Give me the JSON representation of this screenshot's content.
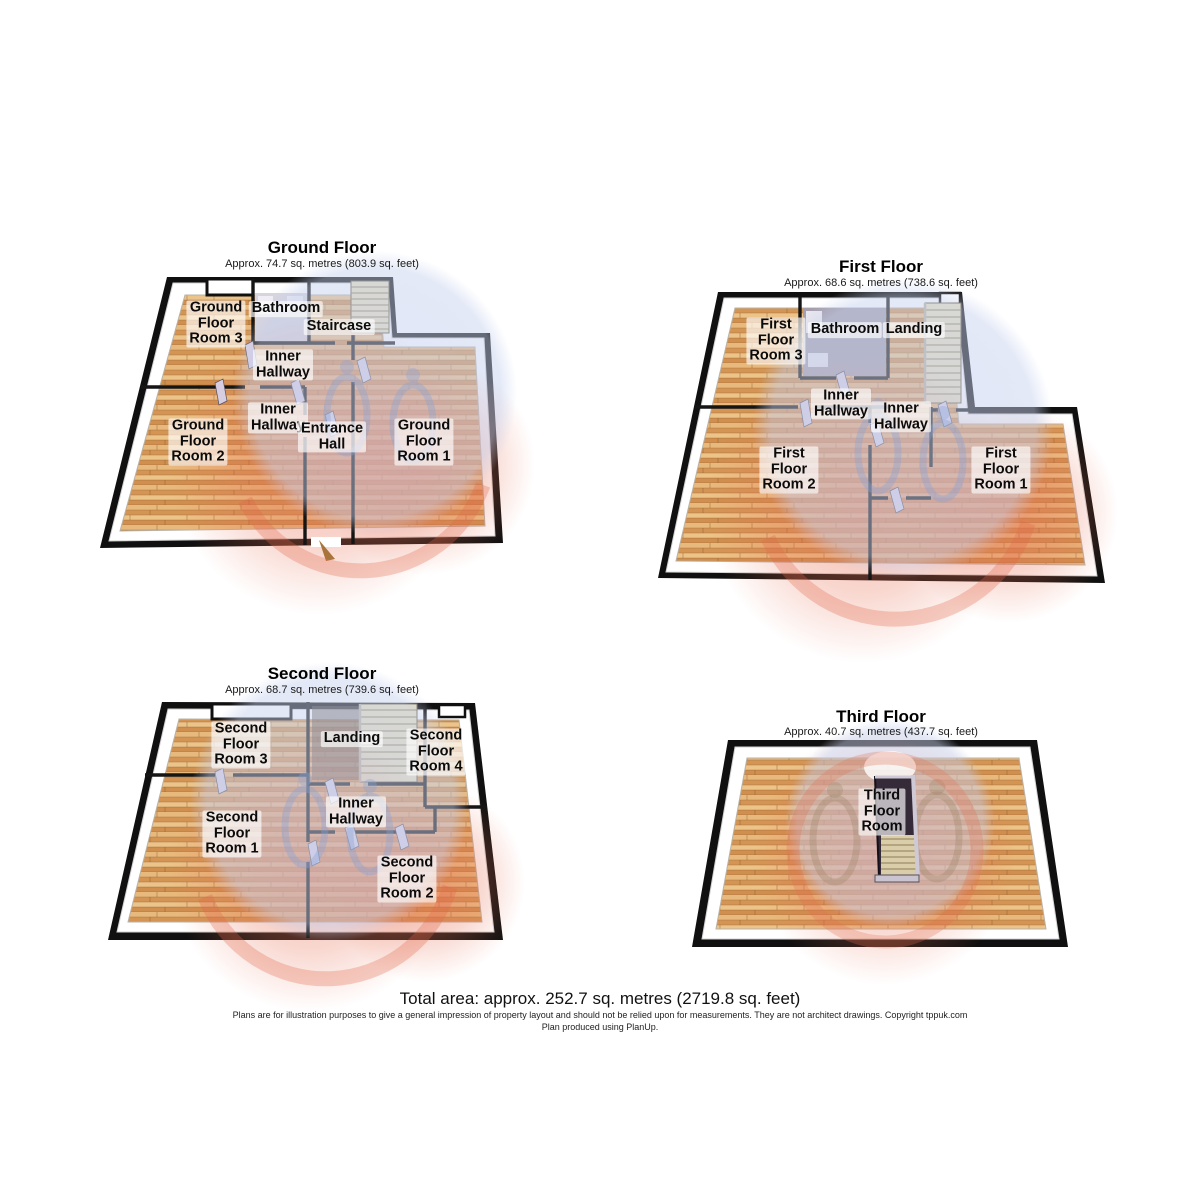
{
  "floors": [
    {
      "title": "Ground Floor",
      "area": "Approx. 74.7 sq. metres (803.9 sq. feet)",
      "rooms": [
        {
          "label": "Ground\nFloor\nRoom 3"
        },
        {
          "label": "Bathroom"
        },
        {
          "label": "Staircase"
        },
        {
          "label": "Inner\nHallway"
        },
        {
          "label": "Inner\nHallway"
        },
        {
          "label": "Entrance\nHall"
        },
        {
          "label": "Ground\nFloor\nRoom 2"
        },
        {
          "label": "Ground\nFloor\nRoom 1"
        }
      ]
    },
    {
      "title": "First Floor",
      "area": "Approx. 68.6 sq. metres (738.6 sq. feet)",
      "rooms": [
        {
          "label": "First\nFloor\nRoom 3"
        },
        {
          "label": "Bathroom"
        },
        {
          "label": "Landing"
        },
        {
          "label": "Inner\nHallway"
        },
        {
          "label": "Inner\nHallway"
        },
        {
          "label": "First\nFloor\nRoom 2"
        },
        {
          "label": "First\nFloor\nRoom 1"
        }
      ]
    },
    {
      "title": "Second Floor",
      "area": "Approx. 68.7 sq. metres (739.6 sq. feet)",
      "rooms": [
        {
          "label": "Second\nFloor\nRoom 3"
        },
        {
          "label": "Landing"
        },
        {
          "label": "Second\nFloor\nRoom 4"
        },
        {
          "label": "Inner\nHallway"
        },
        {
          "label": "Second\nFloor\nRoom 1"
        },
        {
          "label": "Second\nFloor\nRoom 2"
        }
      ]
    },
    {
      "title": "Third Floor",
      "area": "Approx. 40.7 sq. metres (437.7 sq. feet)",
      "rooms": [
        {
          "label": "Third\nFloor\nRoom"
        }
      ]
    }
  ],
  "footer": {
    "total_area": "Total area: approx. 252.7 sq. metres (2719.8 sq. feet)",
    "disclaimer": "Plans are for illustration purposes to give a general impression of property layout and should not be relied upon for measurements. They are not architect drawings.  Copyright tppuk.com",
    "produced_by": "Plan produced using PlanUp."
  },
  "colors": {
    "wall": "#121212",
    "wood_floor": "#dfa868",
    "bevel": "#ffffff",
    "partition_wall": "#d7cde1",
    "stairs": "#e9dfbd",
    "watermark_blue": "#c4d0ee",
    "watermark_red": "#e2705a",
    "label_background": "rgba(255,255,255,0.66)"
  }
}
